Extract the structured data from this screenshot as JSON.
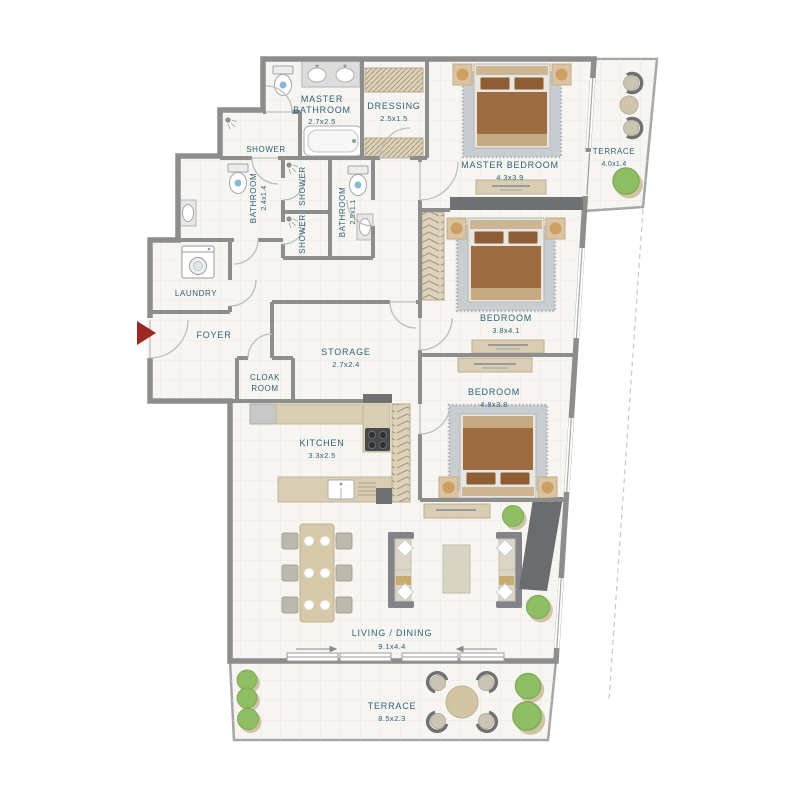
{
  "plan": {
    "rooms": {
      "master_bathroom": {
        "name_line1": "MASTER",
        "name_line2": "BATHROOM",
        "dims": "2.7x2.5"
      },
      "dressing": {
        "name": "DRESSING",
        "dims": "2.5x1.5"
      },
      "shower_top": {
        "name": "SHOWER"
      },
      "bathroom_left": {
        "name": "BATHROOM",
        "dims": "2.4x1.4"
      },
      "shower_stall_1": {
        "name": "SHOWER"
      },
      "shower_stall_2": {
        "name": "SHOWER"
      },
      "bathroom_middle": {
        "name": "BATHROOM",
        "dims": "2.5x1.1"
      },
      "laundry": {
        "name": "LAUNDRY"
      },
      "foyer": {
        "name": "FOYER"
      },
      "storage": {
        "name": "STORAGE",
        "dims": "2.7x2.4"
      },
      "cloak_room": {
        "name_line1": "CLOAK",
        "name_line2": "ROOM"
      },
      "kitchen": {
        "name": "KITCHEN",
        "dims": "3.3x2.5"
      },
      "master_bedroom": {
        "name": "MASTER BEDROOM",
        "dims": "4.3x3.9"
      },
      "bedroom_middle": {
        "name": "BEDROOM",
        "dims": "3.8x4.1"
      },
      "bedroom_lower": {
        "name": "BEDROOM",
        "dims": "4.8x3.8"
      },
      "terrace_right": {
        "name": "TERRACE",
        "dims": "4.0x1.4"
      },
      "living_dining": {
        "name": "LIVING / DINING",
        "dims": "9.1x4.4"
      },
      "terrace_bottom": {
        "name": "TERRACE",
        "dims": "8.5x2.3"
      }
    },
    "colors": {
      "wall": "#8d8d8d",
      "wall_dark": "#6f7173",
      "floor": "#f6f5f2",
      "grid": "#e9e6e0",
      "label": "#2f6173",
      "entry_arrow": "#9d2723",
      "wood_tan": "#d9cdb4",
      "hatch_tan": "#ddd2ba",
      "bed_brown": "#9c6b40",
      "headboard_tan": "#cdb492",
      "rug_gray": "#c9ccd0",
      "plant_green": "#8fbd62"
    }
  }
}
